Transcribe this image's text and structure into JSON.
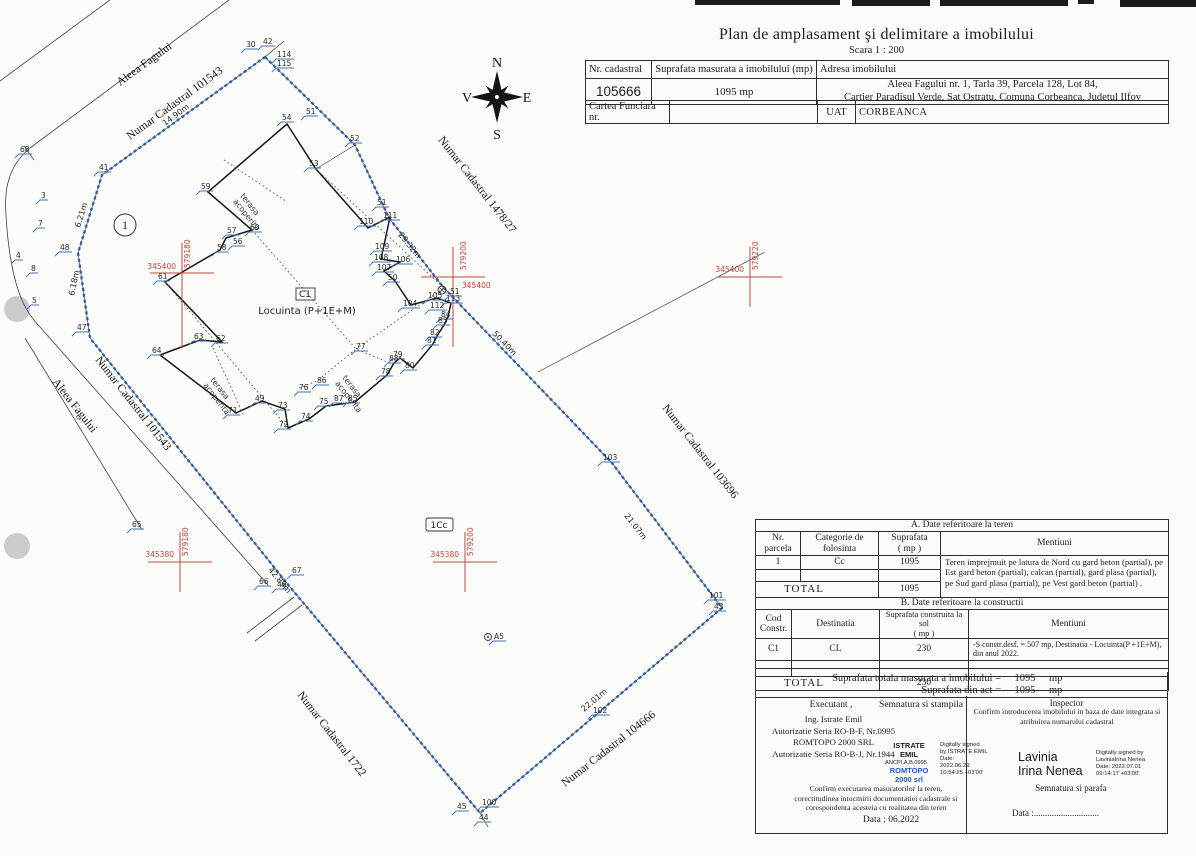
{
  "title": {
    "main": "Plan de amplasament şi delimitare a imobilului",
    "scale": "Scara 1 : 200"
  },
  "header_table": {
    "h_nr": "Nr. cadastral",
    "h_sup": "Suprafata masurata a imobilului (mp)",
    "h_adr": "Adresa  imobilului",
    "nr": "105666",
    "sup": "1095 mp",
    "adr1": "Aleea Fagului nr. 1, Tarla 39, Parcela 128, Lot 84,",
    "adr2": "Cartier Paradisul Verde, Sat Ostratu, Comuna Corbeanca, Judetul Ilfov",
    "cf": "Cartea Funciara  nr.",
    "cf_value": "",
    "uat_l": "UAT",
    "uat_v": "CORBEANCA"
  },
  "table_a": {
    "caption": "A. Date referitoare la teren",
    "h1": "Nr.\nparcela",
    "h2": "Categorie de\nfolosinta",
    "h3": "Suprafata\n( mp )",
    "h4": "Mentiuni",
    "r1_nr": "1",
    "r1_cat": "Cc",
    "r1_sup": "1095",
    "r1_ment": "Teren imprejmuit pe latura de Nord cu gard beton (partial), pe Est gard beton (partial), calcan (partial), gard plasa (partial), pe Sud gard plasa (partial), pe Vest gard beton (partial) .",
    "total_label": "TOTAL",
    "total": "1095"
  },
  "table_b": {
    "caption": "B. Date referitoare la constructii",
    "h1": "Cod\nConstr.",
    "h2": "Destinatia",
    "h3": "Suprafata construita la sol\n( mp )",
    "h4": "Mentiuni",
    "r1_cod": "C1",
    "r1_dest": "CL",
    "r1_sup": "230",
    "r1_ment": "-S constr.desf. = 507 mp, Destinatia - Locuinta(P +1E+M), din anul 2022.",
    "total_label": "TOTAL",
    "total": "230"
  },
  "totals": {
    "l1": "Suprafata totala masurata a imobilului =",
    "v1": "1095",
    "u1": "mp",
    "l2": "Suprafata din act =",
    "v2": "1095",
    "u2": "mp"
  },
  "signatures": {
    "executant_title": "Executant ,",
    "executant_lines": {
      "0": "Ing. Istrate Emil",
      "1": "Autorizatie Seria RO-B-F, Nr.0995",
      "2": "ROMTOPO 2000 SRL",
      "3": "Autorizatie Seria RO-B-J, Nr.1944"
    },
    "semnatura": "Semnatura si stampila",
    "stamp_name": "ISTRATE\nEMIL",
    "stamp_small": "ANCPI,A,B,0995",
    "stamp_co": "ROMTOPO\n2000 srl",
    "stamp_digital": "Digitally signed\nby ISTRATE EMIL\nDate:\n2022.06.29\n10:54:25 +03'00'",
    "confirm_left": "Confirm executarea masuratorilor la teren, corectitudinea intocmirii documentatiei cadastrale si corespondenta acesteia cu realitatea din teren",
    "data_left": "Data :   06.2022",
    "inspector_title": "Inspector",
    "confirm_right": "Confirm introducerea imobilului in baza de date integrata si atribuirea numarului cadastral",
    "ins_name": "Lavinia\nIrina Nenea",
    "ins_digital": "Digitally signed by\nLaviniaIrina Nenea\nDate: 2022.07.01\n09:14:17 +03'00'",
    "semnatura_parafa": "Semnatura si parafa",
    "data_right": "Data :............................."
  },
  "compass": {
    "n": "N",
    "s": "S",
    "e": "E",
    "v": "V"
  },
  "plan": {
    "building_code": "C1",
    "building_name": "Locuinta  (P+1E+M)",
    "parcel_use": "1Cc",
    "parcel_circle": "1",
    "terrace_line1": "terasa",
    "terrace_line2": "acoperita",
    "colors": {
      "boundary": "#2a5fa8",
      "grid": "#c0463c",
      "point_hook": "#3f74b8"
    },
    "points": [
      {
        "n": "68",
        "x": 20,
        "y": 152
      },
      {
        "n": "41",
        "x": 99,
        "y": 170
      },
      {
        "n": "3",
        "x": 41,
        "y": 198
      },
      {
        "n": "7",
        "x": 38,
        "y": 226
      },
      {
        "n": "4",
        "x": 16,
        "y": 258
      },
      {
        "n": "8",
        "x": 31,
        "y": 271
      },
      {
        "n": "48",
        "x": 60,
        "y": 250
      },
      {
        "n": "5",
        "x": 32,
        "y": 303
      },
      {
        "n": "47",
        "x": 77,
        "y": 330
      },
      {
        "n": "30",
        "x": 246,
        "y": 47
      },
      {
        "n": "42",
        "x": 263,
        "y": 44
      },
      {
        "n": "114",
        "x": 277,
        "y": 57
      },
      {
        "n": "115",
        "x": 277,
        "y": 66
      },
      {
        "n": "54",
        "x": 282,
        "y": 120
      },
      {
        "n": "51",
        "x": 306,
        "y": 114
      },
      {
        "n": "52",
        "x": 350,
        "y": 141
      },
      {
        "n": "53",
        "x": 309,
        "y": 166
      },
      {
        "n": "59",
        "x": 201,
        "y": 189
      },
      {
        "n": "57",
        "x": 227,
        "y": 233
      },
      {
        "n": "60",
        "x": 250,
        "y": 230
      },
      {
        "n": "56",
        "x": 233,
        "y": 244
      },
      {
        "n": "58",
        "x": 217,
        "y": 250
      },
      {
        "n": "61",
        "x": 158,
        "y": 279
      },
      {
        "n": "110",
        "x": 359,
        "y": 224
      },
      {
        "n": "51",
        "x": 377,
        "y": 205
      },
      {
        "n": "111",
        "x": 383,
        "y": 218
      },
      {
        "n": "109",
        "x": 375,
        "y": 249
      },
      {
        "n": "108",
        "x": 374,
        "y": 260
      },
      {
        "n": "106",
        "x": 396,
        "y": 262
      },
      {
        "n": "107",
        "x": 377,
        "y": 270
      },
      {
        "n": "50",
        "x": 388,
        "y": 280
      },
      {
        "n": "104",
        "x": 403,
        "y": 306
      },
      {
        "n": "105",
        "x": 428,
        "y": 298
      },
      {
        "n": "113",
        "x": 446,
        "y": 301
      },
      {
        "n": "112",
        "x": 430,
        "y": 308
      },
      {
        "n": "84",
        "x": 441,
        "y": 317
      },
      {
        "n": "83",
        "x": 438,
        "y": 323
      },
      {
        "n": "82",
        "x": 430,
        "y": 335
      },
      {
        "n": "81",
        "x": 427,
        "y": 343
      },
      {
        "n": "77",
        "x": 356,
        "y": 349
      },
      {
        "n": "79",
        "x": 393,
        "y": 357
      },
      {
        "n": "88",
        "x": 389,
        "y": 361
      },
      {
        "n": "80",
        "x": 405,
        "y": 368
      },
      {
        "n": "78",
        "x": 381,
        "y": 374
      },
      {
        "n": "86",
        "x": 317,
        "y": 383
      },
      {
        "n": "76",
        "x": 299,
        "y": 390
      },
      {
        "n": "87",
        "x": 334,
        "y": 401
      },
      {
        "n": "85",
        "x": 348,
        "y": 401
      },
      {
        "n": "75",
        "x": 319,
        "y": 404
      },
      {
        "n": "74",
        "x": 301,
        "y": 419
      },
      {
        "n": "73",
        "x": 278,
        "y": 408
      },
      {
        "n": "72",
        "x": 279,
        "y": 427
      },
      {
        "n": "49",
        "x": 255,
        "y": 401
      },
      {
        "n": "71",
        "x": 228,
        "y": 413
      },
      {
        "n": "63",
        "x": 194,
        "y": 339
      },
      {
        "n": "62",
        "x": 216,
        "y": 341
      },
      {
        "n": "64",
        "x": 152,
        "y": 353
      },
      {
        "n": "65",
        "x": 132,
        "y": 527
      },
      {
        "n": "66",
        "x": 259,
        "y": 584
      },
      {
        "n": "46",
        "x": 277,
        "y": 587
      },
      {
        "n": "67",
        "x": 292,
        "y": 573
      },
      {
        "n": "45",
        "x": 457,
        "y": 809
      },
      {
        "n": "100",
        "x": 482,
        "y": 805
      },
      {
        "n": "44",
        "x": 479,
        "y": 820
      },
      {
        "n": "102",
        "x": 593,
        "y": 713
      },
      {
        "n": "101",
        "x": 709,
        "y": 598
      },
      {
        "n": "43",
        "x": 714,
        "y": 609
      },
      {
        "n": "103",
        "x": 603,
        "y": 460
      },
      {
        "n": "51",
        "x": 450,
        "y": 294
      },
      {
        "n": "A5",
        "x": 494,
        "y": 639
      }
    ],
    "dims": [
      {
        "t": "14.90m",
        "x": 165,
        "y": 126,
        "r": -36
      },
      {
        "t": "6.21m",
        "x": 80,
        "y": 228,
        "r": -73
      },
      {
        "t": "6.18m",
        "x": 74,
        "y": 296,
        "r": -78
      },
      {
        "t": "42.89m",
        "x": 268,
        "y": 570,
        "r": 51
      },
      {
        "t": "29.32m",
        "x": 398,
        "y": 235,
        "r": 51
      },
      {
        "t": "50.40m",
        "x": 492,
        "y": 334,
        "r": 46
      },
      {
        "t": "21.07m",
        "x": 624,
        "y": 516,
        "r": 52
      },
      {
        "t": "22.01m",
        "x": 584,
        "y": 712,
        "r": -40
      }
    ],
    "streets": [
      {
        "t": "Aleea Fagului",
        "x": 120,
        "y": 86,
        "r": -36
      },
      {
        "t": "Numar Cadastral 101543",
        "x": 130,
        "y": 140,
        "r": -36
      },
      {
        "t": "Numar Cadastral 1478/27",
        "x": 438,
        "y": 140,
        "r": 52
      },
      {
        "t": "Numar Cadastral 103696",
        "x": 662,
        "y": 408,
        "r": 52
      },
      {
        "t": "Aleea Fagului",
        "x": 52,
        "y": 382,
        "r": 52
      },
      {
        "t": "Numar Cadastral 101543",
        "x": 95,
        "y": 360,
        "r": 52
      },
      {
        "t": "Numar Cadastral 1722",
        "x": 297,
        "y": 695,
        "r": 52
      },
      {
        "t": "Numar Cadastral 104666",
        "x": 565,
        "y": 787,
        "r": -38
      }
    ],
    "terraces": [
      {
        "x": 240,
        "y": 196
      },
      {
        "x": 210,
        "y": 380
      },
      {
        "x": 342,
        "y": 378
      }
    ],
    "crosses": [
      {
        "x": 182,
        "y": 273,
        "vd": 75,
        "e": "345400",
        "ex": 176,
        "ey": 269,
        "ea": "end",
        "n": "579180",
        "nx": 190,
        "ny": 268
      },
      {
        "x": 453,
        "y": 277,
        "vd": 70,
        "e": "345400",
        "ex": 462,
        "ey": 288,
        "ea": "start",
        "n": "579200",
        "nx": 466,
        "ny": 270
      },
      {
        "x": 750,
        "y": 277,
        "vd": 30,
        "e": "345400",
        "ex": 744,
        "ey": 272,
        "ea": "end",
        "n": "579220",
        "nx": 758,
        "ny": 270
      },
      {
        "x": 180,
        "y": 562,
        "vd": 30,
        "e": "345380",
        "ex": 174,
        "ey": 557,
        "ea": "end",
        "n": "579180",
        "nx": 188,
        "ny": 556
      },
      {
        "x": 465,
        "y": 562,
        "vd": 30,
        "e": "345380",
        "ex": 459,
        "ey": 557,
        "ea": "end",
        "n": "579200",
        "nx": 473,
        "ny": 556
      }
    ]
  }
}
